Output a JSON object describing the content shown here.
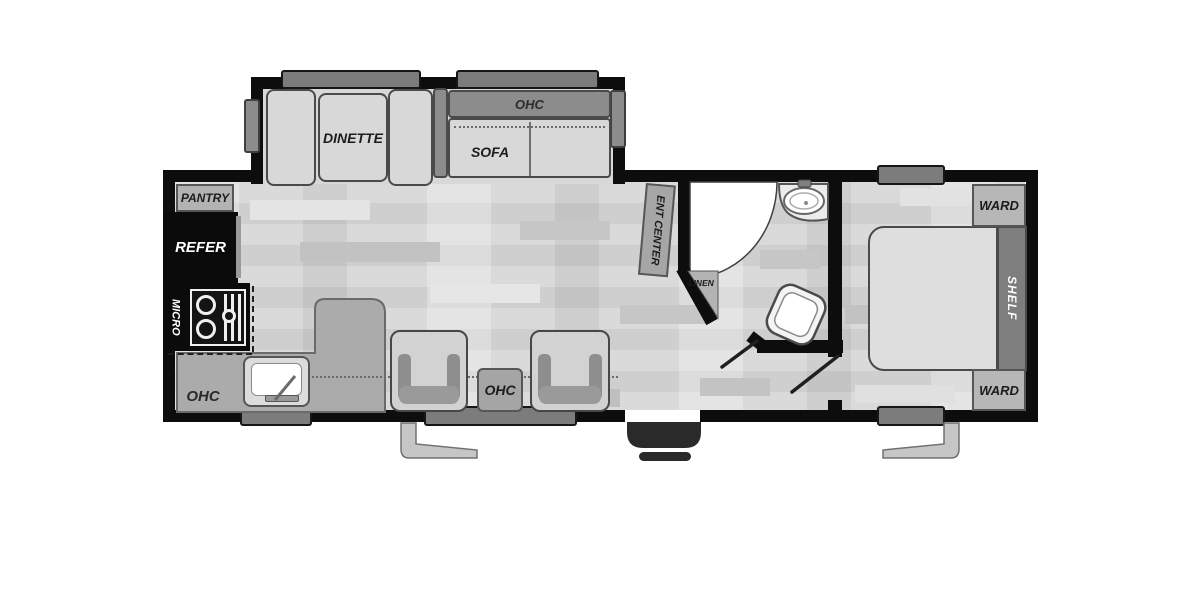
{
  "floorplan": {
    "slide_out": {
      "dinette_label": "DINETTE",
      "sofa_label": "SOFA",
      "ohc_label": "OHC"
    },
    "kitchen": {
      "pantry_label": "PANTRY",
      "refer_label": "REFER",
      "micro_label": "MICRO",
      "ohc_label": "OHC"
    },
    "living": {
      "ent_center_label": "ENT CENTER",
      "ohc_label": "OHC"
    },
    "bathroom": {
      "linen_label": "LINEN"
    },
    "bedroom": {
      "ward_top_label": "WARD",
      "shelf_label": "SHELF",
      "ward_bottom_label": "WARD"
    },
    "colors": {
      "wall": "#0d0d0d",
      "floor": "#d6d6d6",
      "furniture": "#d8d8d8",
      "dark_accent": "#8c8c8c",
      "window": "#7c7c7c",
      "counter": "#ababab",
      "appliance_black": "#0b0b0b",
      "door_swing": "#ffffff"
    }
  }
}
